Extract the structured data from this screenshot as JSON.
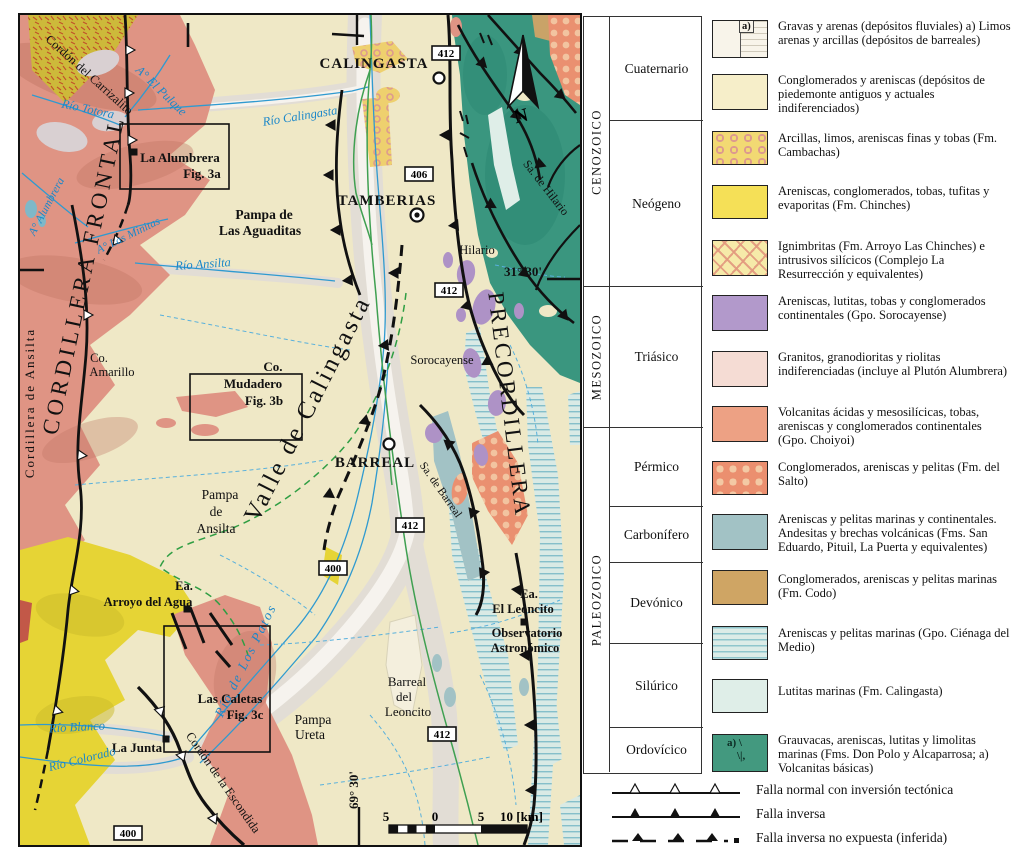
{
  "map": {
    "towns": {
      "calingasta": "CALINGASTA",
      "tamberias": "TAMBERIAS",
      "barreal": "BARREAL"
    },
    "settlements": {
      "hilario": "Hilario",
      "sorocayense": "Sorocayense",
      "la_junta": "La Junta",
      "ea_arroyo_l1": "Ea.",
      "ea_arroyo_l2": "Arroyo del Agua",
      "ea_leoncito_l1": "Ea.",
      "ea_leoncito_l2": "El Leoncito",
      "observatorio_l1": "Observatorio",
      "observatorio_l2": "Astronómico"
    },
    "physio": {
      "cordillera_frontal": "CORDILLERA FRONTAL",
      "cordillera_ansilta": "Cordillera de Ansilta",
      "precordillera": "PRECORDILLERA",
      "valle_calingasta": "Valle de Calingasta",
      "sa_hilario": "Sa. de Hilario",
      "sa_barreal": "Sa. de Barreal",
      "cordon_carrizalito": "Cordón del Carrizalito",
      "cordon_escondida": "Cordón de la Escondida",
      "co_amarillo_l1": "Co.",
      "co_amarillo_l2": "Amarillo",
      "pampa_aguaditas_l1": "Pampa de",
      "pampa_aguaditas_l2": "Las Aguaditas",
      "pampa_ansilta_l1": "Pampa",
      "pampa_ansilta_l2": "de",
      "pampa_ansilta_l3": "Ansilta",
      "pampa_ureta_l1": "Pampa",
      "pampa_ureta_l2": "Ureta",
      "barreal_leoncito_l1": "Barreal",
      "barreal_leoncito_l2": "del",
      "barreal_leoncito_l3": "Leoncito"
    },
    "rivers": {
      "rio_totora": "Río Totora",
      "a_el_pulque": "A° El Pulque",
      "a_alumbrera": "A° Alumbrera",
      "a_las_minitas": "A° Las Minitas",
      "rio_calingasta": "Río Calingasta",
      "rio_ansilta": "Río Ansilta",
      "rio_los_patos": "Río de Los Patos",
      "rio_blanco": "Río Blanco",
      "rio_colorado": "Río Colorado"
    },
    "figures": {
      "alumbrera_l1": "La Alumbrera",
      "alumbrera_l2": "Fig. 3a",
      "mudadero_l0": "Co.",
      "mudadero_l1": "Mudadero",
      "mudadero_l2": "Fig. 3b",
      "caletas_l1": "Las Caletas",
      "caletas_l2": "Fig. 3c"
    },
    "routes": {
      "r412": "412",
      "r406": "406",
      "r400": "400"
    },
    "graticule": {
      "lat": "31° 30'",
      "lon": "69° 30'"
    },
    "scalebar": {
      "left5": "5",
      "zero": "0",
      "right5": "5",
      "right10": "10 [km]"
    },
    "north_label": "N"
  },
  "legend": {
    "eras": [
      {
        "name": "CENOZOICO"
      },
      {
        "name": "MESOZOICO"
      },
      {
        "name": "PALEOZOICO"
      }
    ],
    "periods": [
      {
        "name": "Cuaternario"
      },
      {
        "name": "Neógeno"
      },
      {
        "name": "Triásico"
      },
      {
        "name": "Pérmico"
      },
      {
        "name": "Carbonífero"
      },
      {
        "name": "Devónico"
      },
      {
        "name": "Silúrico"
      },
      {
        "name": "Ordovícico"
      }
    ],
    "items": [
      {
        "desc": "Gravas y arenas (depósitos fluviales) a) Limos arenas y arcillas (depósitos de barreales)",
        "sub": "a)"
      },
      {
        "desc": "Conglomerados y areniscas (depósitos de piedemonte antiguos y actuales indiferenciados)"
      },
      {
        "desc": "Arcillas, limos, areniscas finas y tobas (Fm. Cambachas)"
      },
      {
        "desc": "Areniscas, conglomerados, tobas, tufitas y evaporitas (Fm. Chinches)"
      },
      {
        "desc": "Ignimbritas (Fm. Arroyo Las Chinches) e intrusivos silícicos (Complejo La Resurrección y equivalentes)"
      },
      {
        "desc": "Areniscas, lutitas, tobas y conglomerados continentales (Gpo. Sorocayense)"
      },
      {
        "desc": "Granitos, granodioritas y riolitas indiferenciadas (incluye al Plutón Alumbrera)"
      },
      {
        "desc": "Volcanitas ácidas y mesosilícicas, tobas, areniscas y conglomerados continentales (Gpo. Choiyoi)"
      },
      {
        "desc": "Conglomerados, areniscas y pelitas (Fm. del Salto)"
      },
      {
        "desc": "Areniscas y pelitas marinas y continentales. Andesitas y brechas volcánicas (Fms. San Eduardo, Pituil, La Puerta y equivalentes)"
      },
      {
        "desc": "Conglomerados, areniscas y pelitas marinas (Fm. Codo)"
      },
      {
        "desc": "Areniscas y pelitas marinas (Gpo. Ciénaga del Medio)"
      },
      {
        "desc": "Lutitas marinas (Fm. Calingasta)"
      },
      {
        "desc": "Grauvacas, areniscas, lutitas y limolitas marinas (Fms. Don Polo y Alcaparrosa; a) Volcanitas básicas)",
        "mark1": "a) \\",
        "mark2": "\\|,"
      }
    ],
    "faults": [
      {
        "label": "Falla normal con inversión tectónica"
      },
      {
        "label": "Falla inversa"
      },
      {
        "label": "Falla inversa no expuesta (inferida)"
      }
    ]
  },
  "colors": {
    "quaternary_fan": "#f6eec9",
    "cambachas": "#f2d973",
    "chinches": "#f5e057",
    "ignimbrite": "#f6eaa9",
    "sorocayense": "#b299cb",
    "granite": "#f5dcd4",
    "choiyoi": "#df9484",
    "del_salto": "#eb8f6f",
    "carboniferous": "#a2c2c5",
    "codo": "#c9a368",
    "cienaga": "#dcece7",
    "calingasta_fm": "#dfeee8",
    "ordovician": "#3a967f",
    "river_blue": "#2f9ad0",
    "road_green": "#3fa051"
  }
}
